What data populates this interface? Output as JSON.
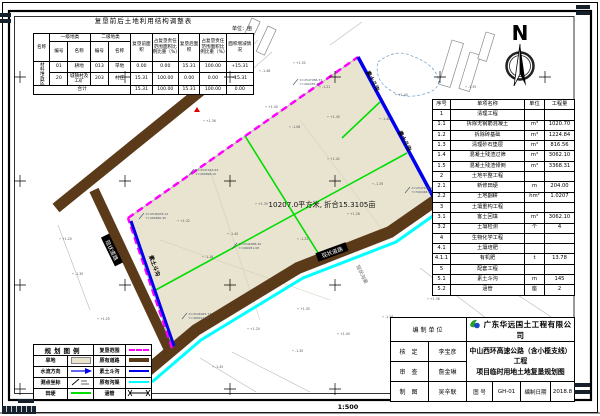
{
  "landuse_table": {
    "title": "复垦前后土地利用结构调整表",
    "unit_note": "单位：亩",
    "col_name": "名称",
    "group1": "一级地类",
    "group2": "二级地类",
    "code": "编号",
    "cls": "名称",
    "pre_area": "复垦前面积",
    "pre_pct": "占复垦责任范围面积比例比重（%）",
    "post_area": "复垦后面积",
    "post_pct": "占复垦责任范围面积比例比重（%）",
    "change": "面积增减情况",
    "row_group": "材料堆放区",
    "rows": [
      [
        "01",
        "耕地",
        "013",
        "旱地",
        "0.00",
        "0.00",
        "15.31",
        "100.00",
        "+15.31"
      ],
      [
        "20",
        "城镇村及工矿",
        "203",
        "村庄",
        "15.31",
        "100.00",
        "0.00",
        "0.00",
        "-15.31"
      ]
    ],
    "total_label": "合计",
    "total": [
      "15.31",
      "100.00",
      "15.31",
      "100.00",
      "0.00"
    ]
  },
  "quantity_table": {
    "headers": [
      "序号",
      "单项名称",
      "单位",
      "工程量"
    ],
    "rows": [
      [
        "1",
        "清理工程",
        "",
        ""
      ],
      [
        "1.1",
        "拆除无钢筋混凝土",
        "m³",
        "1020.70"
      ],
      [
        "1.2",
        "拆除砖基础",
        "m³",
        "1224.84"
      ],
      [
        "1.3",
        "清理砂石垫层",
        "m³",
        "816.56"
      ],
      [
        "1.4",
        "混凝土残渣过筛",
        "m³",
        "3062.10"
      ],
      [
        "1.5",
        "混凝土残渣倾倒",
        "m³",
        "3368.31"
      ],
      [
        "2",
        "土地平整工程",
        "",
        ""
      ],
      [
        "2.1",
        "新修田埂",
        "m",
        "204.00"
      ],
      [
        "2.2",
        "土地翻耕",
        "hm²",
        "1.0207"
      ],
      [
        "3",
        "土壤重构工程",
        "",
        ""
      ],
      [
        "3.1",
        "客土回填",
        "m³",
        "3062.10"
      ],
      [
        "3.2",
        "土壤检测",
        "个",
        "4"
      ],
      [
        "4",
        "生物化学工程",
        "",
        ""
      ],
      [
        "4.1",
        "土壤培肥",
        "",
        ""
      ],
      [
        "4.1.1",
        "有机肥",
        "t",
        "13.78"
      ],
      [
        "5",
        "配套工程",
        "",
        ""
      ],
      [
        "5.1",
        "素土斗沟",
        "m",
        "145"
      ],
      [
        "5.2",
        "涵管",
        "座",
        "2"
      ]
    ]
  },
  "legend": {
    "title": "规划图例",
    "items": {
      "dryland": "旱地",
      "flow_dir": "水流方向",
      "survey_pt": "测点坐标",
      "field_ridge": "田埂",
      "reclaim_bound": "复垦范围",
      "exist_road": "原有道路",
      "soil_ditch": "素土斗沟",
      "exist_channel": "原有沟渠",
      "culvert": "涵管"
    }
  },
  "title_block": {
    "unit_label": "编制单位",
    "company": "广东华远国土工程有限公司",
    "check_label": "核 定",
    "check_name": "李宝彦",
    "review_label": "审 查",
    "review_name": "詹金琳",
    "draft_label": "制 图",
    "draft_name": "吴辛联",
    "project_line1": "中山西环高速公路（含小榄支线）工程",
    "project_line2": "项目临时用地土地复垦规划图",
    "dwg_no_label": "图 号",
    "dwg_no": "GH-01",
    "date_label": "编制日期",
    "date": "2018.8"
  },
  "map": {
    "north": "N",
    "area_label": "10207.0平方米, 折合15.3105亩",
    "ditch_label": "素土斗沟",
    "road_label": "现状道路",
    "channel_label": "现状沟渠",
    "survey_points": [
      {
        "x": 297,
        "y": 82,
        "l1": "X=2547086.33",
        "l2": "Y=499935.27"
      },
      {
        "x": 193,
        "y": 172,
        "l1": "X=2547016.64",
        "l2": "Y=499898.10"
      },
      {
        "x": 143,
        "y": 216,
        "l1": "X=2546978.12",
        "l2": "Y=499860.45"
      },
      {
        "x": 409,
        "y": 190,
        "l1": "X=2547038.90",
        "l2": "Y=500048.62"
      },
      {
        "x": 186,
        "y": 316,
        "l1": "X=2546925.77",
        "l2": "Y=499912.39"
      },
      {
        "x": 236,
        "y": 246,
        "l1": "X=2546968.40",
        "l2": "Y=499951.08"
      }
    ],
    "spots": [
      {
        "x": 262,
        "y": 72,
        "v": "-1.48"
      },
      {
        "x": 296,
        "y": 64,
        "v": "+1.52"
      },
      {
        "x": 322,
        "y": 88,
        "v": "-1.21"
      },
      {
        "x": 268,
        "y": 108,
        "v": "+1.40"
      },
      {
        "x": 238,
        "y": 92,
        "v": "-0.85"
      },
      {
        "x": 206,
        "y": 122,
        "v": "+1.36"
      },
      {
        "x": 292,
        "y": 128,
        "v": "-1.08"
      },
      {
        "x": 330,
        "y": 118,
        "v": "+1.45"
      },
      {
        "x": 382,
        "y": 120,
        "v": "-1.48"
      },
      {
        "x": 398,
        "y": 96,
        "v": "+1.40"
      },
      {
        "x": 452,
        "y": 118,
        "v": "+1.48"
      },
      {
        "x": 468,
        "y": 88,
        "v": "-1.35"
      },
      {
        "x": 500,
        "y": 128,
        "v": "+1.42"
      },
      {
        "x": 524,
        "y": 108,
        "v": "-1.18"
      },
      {
        "x": 548,
        "y": 142,
        "v": "+1.30"
      },
      {
        "x": 512,
        "y": 170,
        "v": "-1.42"
      },
      {
        "x": 545,
        "y": 205,
        "v": "+1.25"
      },
      {
        "x": 490,
        "y": 225,
        "v": "-1.36"
      },
      {
        "x": 520,
        "y": 258,
        "v": "+1.44"
      },
      {
        "x": 470,
        "y": 275,
        "v": "-1.15"
      },
      {
        "x": 430,
        "y": 300,
        "v": "+1.38"
      },
      {
        "x": 385,
        "y": 318,
        "v": "-1.26"
      },
      {
        "x": 340,
        "y": 335,
        "v": "+1.40"
      },
      {
        "x": 295,
        "y": 352,
        "v": "-1.30"
      },
      {
        "x": 250,
        "y": 330,
        "v": "+1.20"
      },
      {
        "x": 215,
        "y": 368,
        "v": "-1.45"
      },
      {
        "x": 300,
        "y": 310,
        "v": "+1.35"
      },
      {
        "x": 230,
        "y": 235,
        "v": "-1.40"
      },
      {
        "x": 258,
        "y": 205,
        "v": "+1.30"
      },
      {
        "x": 300,
        "y": 240,
        "v": "-1.22"
      },
      {
        "x": 350,
        "y": 215,
        "v": "+1.28"
      },
      {
        "x": 375,
        "y": 185,
        "v": "-1.35"
      },
      {
        "x": 330,
        "y": 160,
        "v": "+1.42"
      },
      {
        "x": 205,
        "y": 258,
        "v": "-1.18"
      },
      {
        "x": 180,
        "y": 222,
        "v": "+1.32"
      },
      {
        "x": 100,
        "y": 320,
        "v": "+1.25"
      },
      {
        "x": 75,
        "y": 275,
        "v": "-1.30"
      },
      {
        "x": 62,
        "y": 240,
        "v": "+1.20"
      }
    ]
  },
  "footer": {
    "scale": "1:500"
  },
  "colors": {
    "reclaim_boundary": "#ff00ff",
    "soil_ditch": "#0000ee",
    "exist_channel": "#00ffff",
    "exist_road": "#5b3a1a",
    "field_ridge": "#00dd00",
    "dryland_fill": "#e9e4d0"
  }
}
